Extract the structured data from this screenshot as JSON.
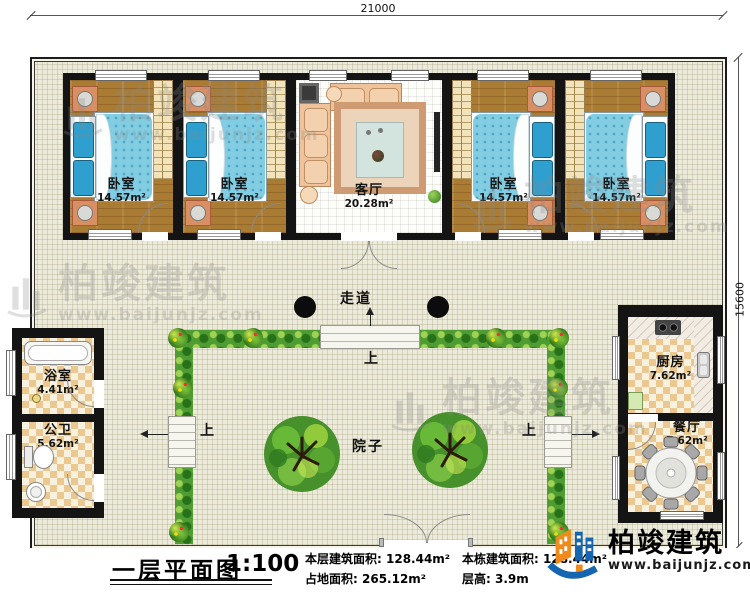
{
  "dimensions": {
    "width_mm": "21000",
    "height_mm": "15600"
  },
  "rooms": [
    {
      "id": "bedroom-1",
      "label": "卧室",
      "area": "14.57m²"
    },
    {
      "id": "bedroom-2",
      "label": "卧室",
      "area": "14.57m²"
    },
    {
      "id": "living-room",
      "label": "客厅",
      "area": "20.28m²"
    },
    {
      "id": "bedroom-3",
      "label": "卧室",
      "area": "14.57m²"
    },
    {
      "id": "bedroom-4",
      "label": "卧室",
      "area": "14.57m²"
    },
    {
      "id": "bathroom",
      "label": "浴室",
      "area": "4.41m²"
    },
    {
      "id": "wc",
      "label": "公卫",
      "area": "5.62m²"
    },
    {
      "id": "kitchen",
      "label": "厨房",
      "area": "7.62m²"
    },
    {
      "id": "dining-room",
      "label": "餐厅",
      "area": "7.62m²"
    }
  ],
  "annotations": {
    "corridor": "走道",
    "courtyard": "院子",
    "up": "上"
  },
  "title_block": {
    "title": "一层平面图",
    "scale": "1:100",
    "stats": [
      {
        "label": "本层建筑面积:",
        "value": "128.44m²"
      },
      {
        "label": "占地面积:",
        "value": "265.12m²"
      },
      {
        "label": "本栋建筑面积:",
        "value": "128.44m²"
      },
      {
        "label": "层高:",
        "value": "3.9m"
      }
    ]
  },
  "brand": {
    "company": "柏竣建筑",
    "website": "www.baijunjz.com"
  },
  "watermark": {
    "text": "柏竣建筑",
    "website": "www.baijunjz.com"
  },
  "colors": {
    "wall": "#141414",
    "wood_floor": "#aa7b33",
    "bed_blue": "#82cde2",
    "checker_tan": "#eac88f",
    "hedge_green": "#4f9c33",
    "brand_blue": "#1565b0",
    "brand_orange": "#ef8b1c"
  }
}
